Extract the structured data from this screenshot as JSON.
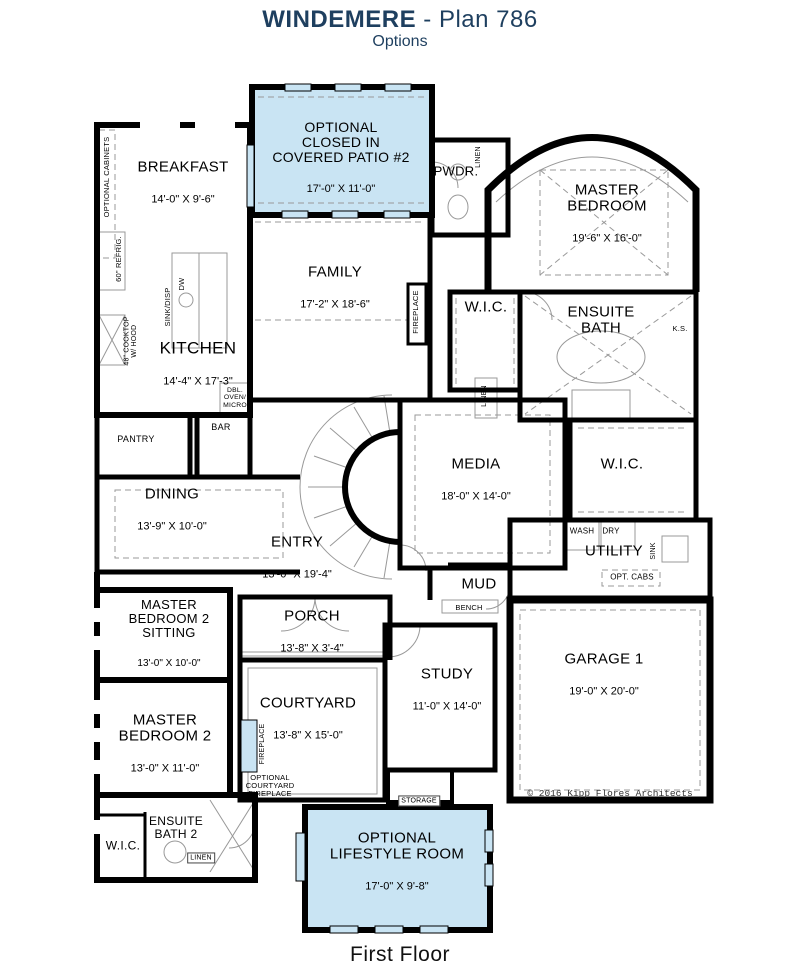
{
  "header": {
    "title_bold": "WINDEMERE",
    "title_rest": " - Plan 786",
    "subtitle": "Options"
  },
  "footer": {
    "label": "First Floor"
  },
  "plan": {
    "copyright": "© 2016 Kipp Flores Architects",
    "colors": {
      "accent": "#1e3f5f",
      "optional_fill": "#c9e4f3",
      "wall": "#000000"
    },
    "rooms": {
      "patio2": {
        "name": "OPTIONAL\nCLOSED IN\nCOVERED PATIO #2",
        "dims": "17'-0\" X 11'-0\"",
        "optional": true
      },
      "breakfast": {
        "name": "BREAKFAST",
        "dims": "14'-0\" X 9'-6\""
      },
      "pwdr": {
        "name": "PWDR."
      },
      "master_bedroom": {
        "name": "MASTER\nBEDROOM",
        "dims": "19'-6\" X 16'-0\""
      },
      "family": {
        "name": "FAMILY",
        "dims": "17'-2\" X 18'-6\""
      },
      "kitchen": {
        "name": "KITCHEN",
        "dims": "14'-4\" X 17'-3\""
      },
      "wic_master": {
        "name": "W.I.C."
      },
      "ensuite_bath": {
        "name": "ENSUITE\nBATH"
      },
      "media": {
        "name": "MEDIA",
        "dims": "18'-0\" X 14'-0\""
      },
      "wic2": {
        "name": "W.I.C."
      },
      "pantry": {
        "name": "PANTRY"
      },
      "bar": {
        "name": "BAR"
      },
      "dining": {
        "name": "DINING",
        "dims": "13'-9\" X 10'-0\""
      },
      "entry": {
        "name": "ENTRY",
        "dims": "13'-0\" X 19'-4\""
      },
      "utility": {
        "name": "UTILITY"
      },
      "mud": {
        "name": "MUD"
      },
      "mb2_sitting": {
        "name": "MASTER\nBEDROOM 2\nSITTING",
        "dims": "13'-0\" X 10'-0\""
      },
      "porch": {
        "name": "PORCH",
        "dims": "13'-8\" X 3'-4\""
      },
      "study": {
        "name": "STUDY",
        "dims": "11'-0\" X 14'-0\""
      },
      "garage1": {
        "name": "GARAGE 1",
        "dims": "19'-0\" X 20'-0\""
      },
      "master_bedroom2": {
        "name": "MASTER\nBEDROOM 2",
        "dims": "13'-0\" X 11'-0\""
      },
      "courtyard": {
        "name": "COURTYARD",
        "dims": "13'-8\" X 15'-0\""
      },
      "ensuite_bath2": {
        "name": "ENSUITE\nBATH 2"
      },
      "wic_bottom": {
        "name": "W.I.C."
      },
      "storage": {
        "name": "STORAGE"
      },
      "lifestyle": {
        "name": "OPTIONAL\nLIFESTYLE ROOM",
        "dims": "17'-0\" X 9'-8\"",
        "optional": true
      }
    },
    "annotations": {
      "optional_cabinets": "OPTIONAL CABINETS",
      "refrig": "60\" REFRIG.",
      "cooktop": "48\" COOKTOP\nW/ HOOD",
      "sink_disp": "SINK/DISP",
      "dw": "DW",
      "dbl_oven_micro": "DBL.\nOVEN/\nMICRO",
      "pwdr_linen": "LINEN",
      "fireplace_family": "FIREPLACE",
      "ks": "K.S.",
      "ensuite_linen": "LINEN",
      "wash": "WASH",
      "dry": "DRY",
      "sink": "SINK",
      "opt_cabs": "OPT. CABS",
      "bench": "BENCH",
      "fireplace_courtyard": "FIREPLACE",
      "opt_courtyard_fireplace": "OPTIONAL\nCOURTYARD\nFIREPLACE",
      "bath2_linen": "LINEN"
    }
  }
}
